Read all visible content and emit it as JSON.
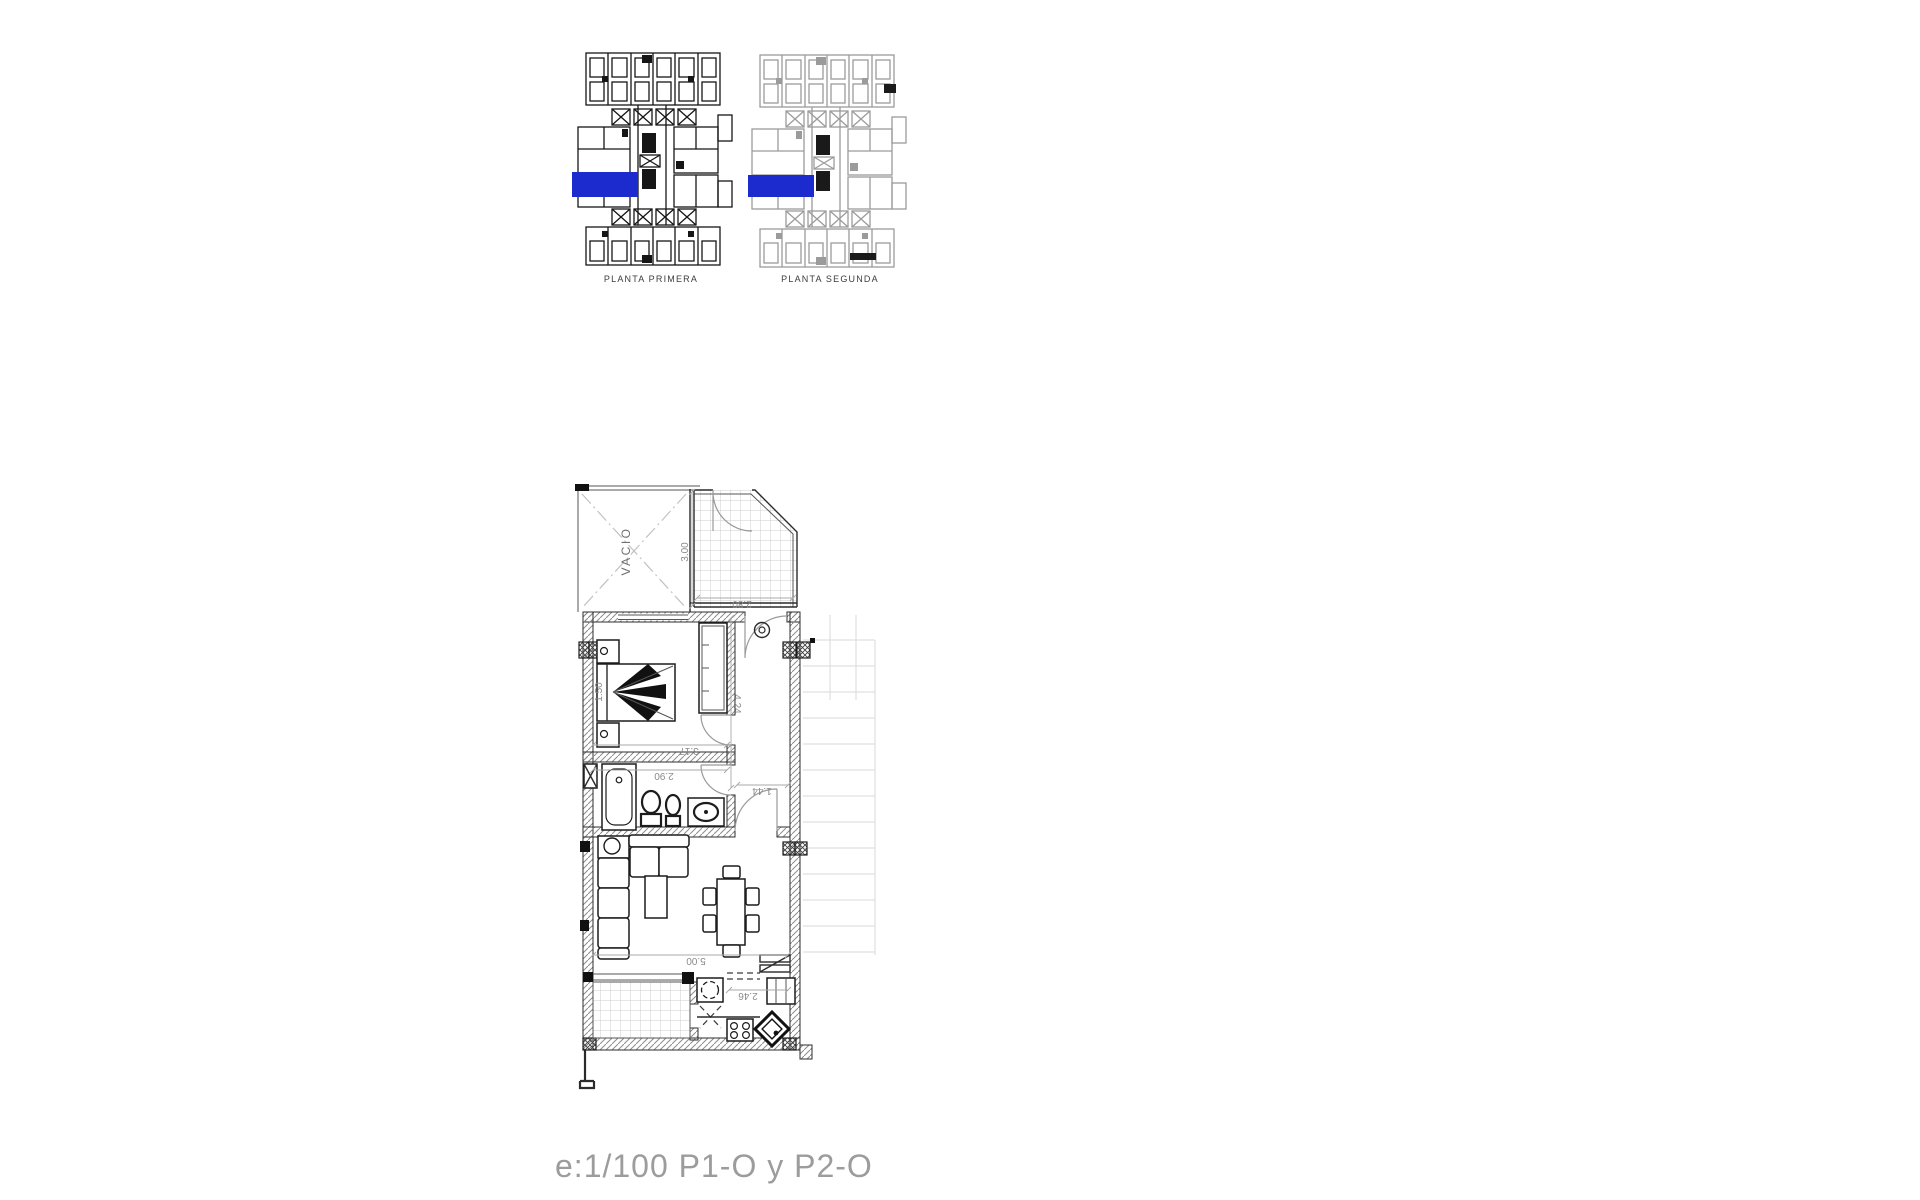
{
  "document": {
    "background": "#ffffff",
    "footer": {
      "scale_text": "e:1/100  P1-O y P2-O",
      "color": "#9c9c9c"
    }
  },
  "overview": {
    "plans": [
      {
        "id": "planta-primera",
        "label": "PLANTA PRIMERA",
        "linework": "dark",
        "highlight_color": "#1c2bcd"
      },
      {
        "id": "planta-segunda",
        "label": "PLANTA SEGUNDA",
        "linework": "light",
        "highlight_color": "#1c2bcd"
      }
    ]
  },
  "apartment": {
    "room_labels": {
      "void": "VACIO"
    },
    "dimensions": {
      "terrace_height": "3.00",
      "terrace_width": "2.80",
      "bedroom_width": "3.17",
      "bathroom_width": "2.90",
      "hall_length": "4.24",
      "hall_width": "1.44",
      "living_width": "5.00",
      "kitchen_width": "2.46",
      "bed_width": "1.50"
    }
  }
}
